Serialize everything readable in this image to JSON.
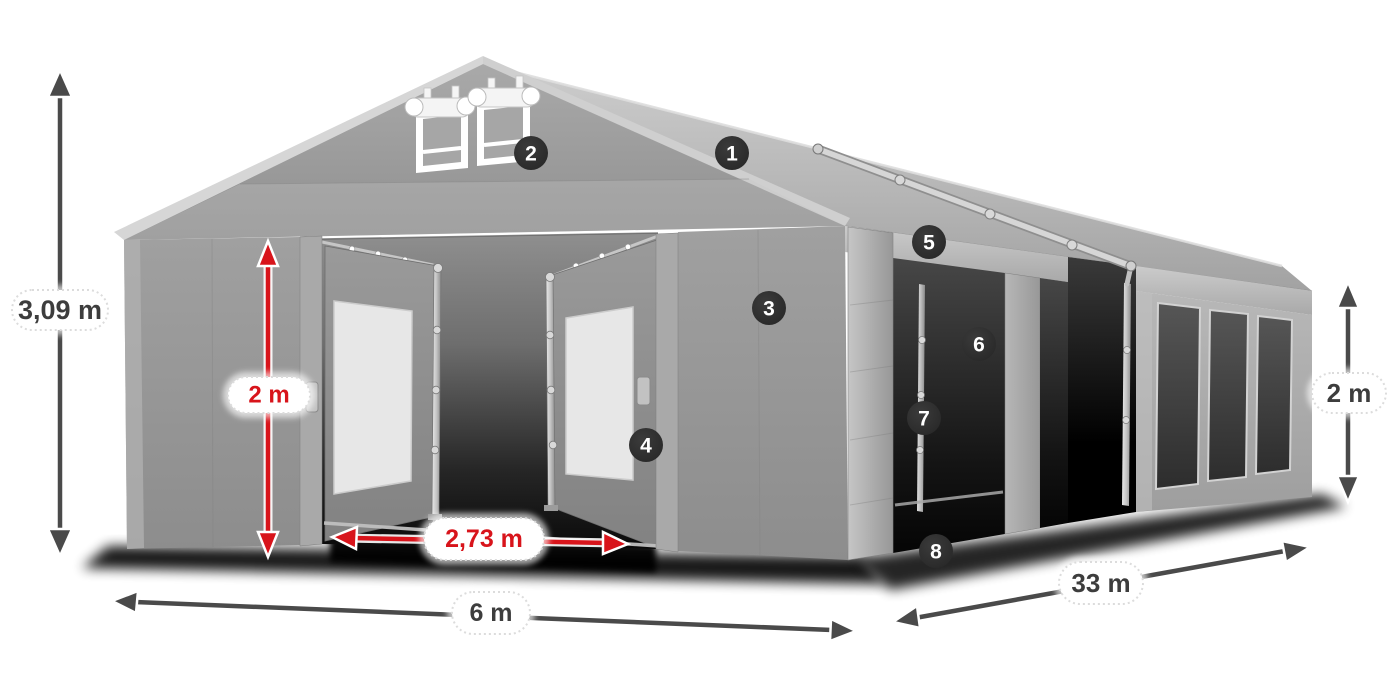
{
  "figure": {
    "type": "product-dimension-diagram",
    "subject": "gray marquee tent with open entrance, side openings and windows"
  },
  "dimensions": {
    "height_total": "3,09 m",
    "entrance_height": "2 m",
    "entrance_width": "2,73 m",
    "width_front": "6 m",
    "length_side": "33 m",
    "height_side": "2 m"
  },
  "badges": [
    "1",
    "2",
    "3",
    "4",
    "5",
    "6",
    "7",
    "8"
  ],
  "colors": {
    "dimension_red": "#d8141b",
    "dimension_dark": "#4a4a4a",
    "badge_background": "#2c2c2c",
    "label_text": "#3d3d3d",
    "tent_light_gray": "#c9c9c9",
    "tent_mid_gray": "#9b9b9b",
    "opening_dark": "#0a0a0a"
  }
}
